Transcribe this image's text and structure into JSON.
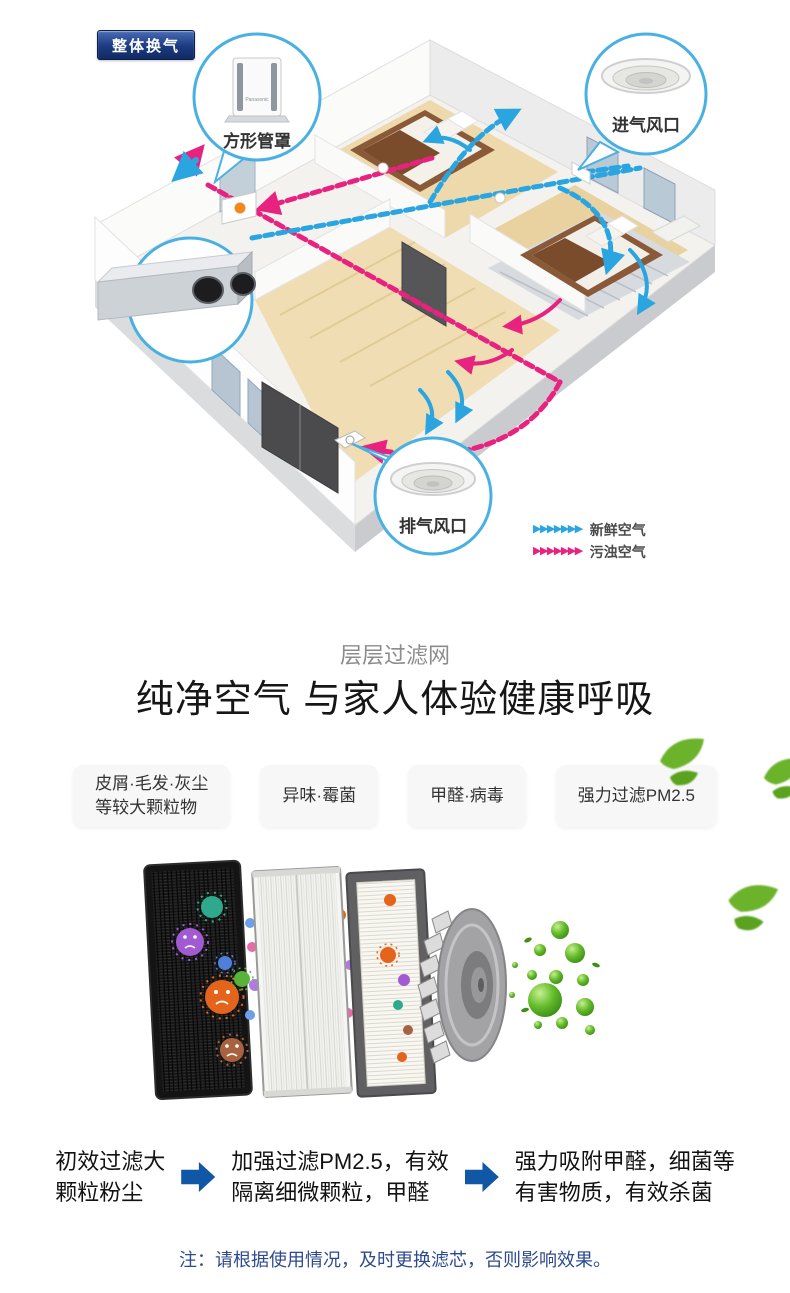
{
  "colors": {
    "fresh_air": "#2aa5e0",
    "polluted_air": "#e8237f",
    "callout_stroke": "#49b0e2",
    "badge_navy": "#1b3a80",
    "step_arrow_blue": "#1057a6",
    "note_blue": "#2e4a8e",
    "leaf_green": "#6cb32c"
  },
  "ventilation_diagram": {
    "badge": "整体换气",
    "duct_cover_label": "方形管罩",
    "product_brand": "Panasonic",
    "intake_vent_label": "进气风口",
    "exhaust_vent_label": "排气风口",
    "legend": {
      "fresh": "新鲜空气",
      "polluted": "污浊空气"
    }
  },
  "filter_intro": {
    "subtitle": "层层过滤网",
    "title": "纯净空气 与家人体验健康呼吸"
  },
  "pollutant_tags": [
    {
      "line1": "皮屑·毛发·灰尘",
      "line2": "等较大颗粒物"
    },
    {
      "line1": "异味·霉菌",
      "line2": ""
    },
    {
      "line1": "甲醛·病毒",
      "line2": ""
    },
    {
      "line1": "强力过滤PM2.5",
      "line2": ""
    }
  ],
  "filter_steps": [
    {
      "line1": "初效过滤大",
      "line2": "颗粒粉尘"
    },
    {
      "line1": "加强过滤PM2.5，有效",
      "line2": "隔离细微颗粒，甲醛"
    },
    {
      "line1": "强力吸附甲醛，细菌等",
      "line2": "有害物质，有效杀菌"
    }
  ],
  "note": "注：请根据使用情况，及时更换滤芯，否则影响效果。"
}
